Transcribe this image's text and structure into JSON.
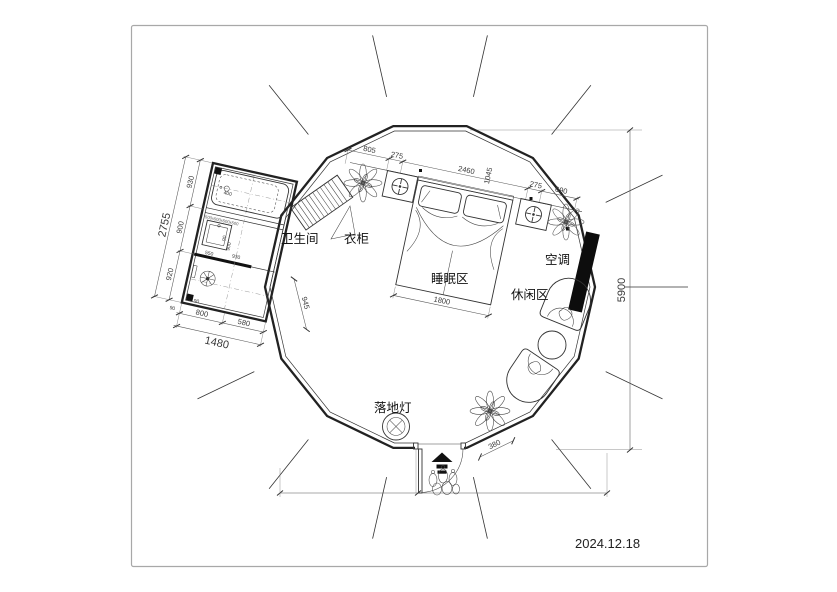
{
  "frame": {
    "date": "2024.12.18"
  },
  "rooms": {
    "bathroom": "卫生间",
    "wardrobe": "衣柜",
    "sleeping_area": "睡眠区",
    "leisure_area": "休闲区",
    "air_conditioner": "空调",
    "floor_lamp": "落地灯"
  },
  "dimensions": {
    "top_chain": [
      "805",
      "275",
      "2460",
      "275",
      "690"
    ],
    "top_vertical": "1045",
    "bed_width": "1800",
    "overall_height": "5900",
    "entry_width": "380",
    "bathroom": {
      "total_height": "2755",
      "height_segments": [
        "930",
        "900",
        "920"
      ],
      "bottom_segments": [
        "800",
        "580"
      ],
      "total_width": "1480",
      "edge": "945",
      "sink": "550",
      "inner_width": "930",
      "inner_height": "900",
      "tub": "400",
      "stub": "90",
      "drain_offset": "90",
      "tub_note": "500x500x500x500"
    }
  }
}
